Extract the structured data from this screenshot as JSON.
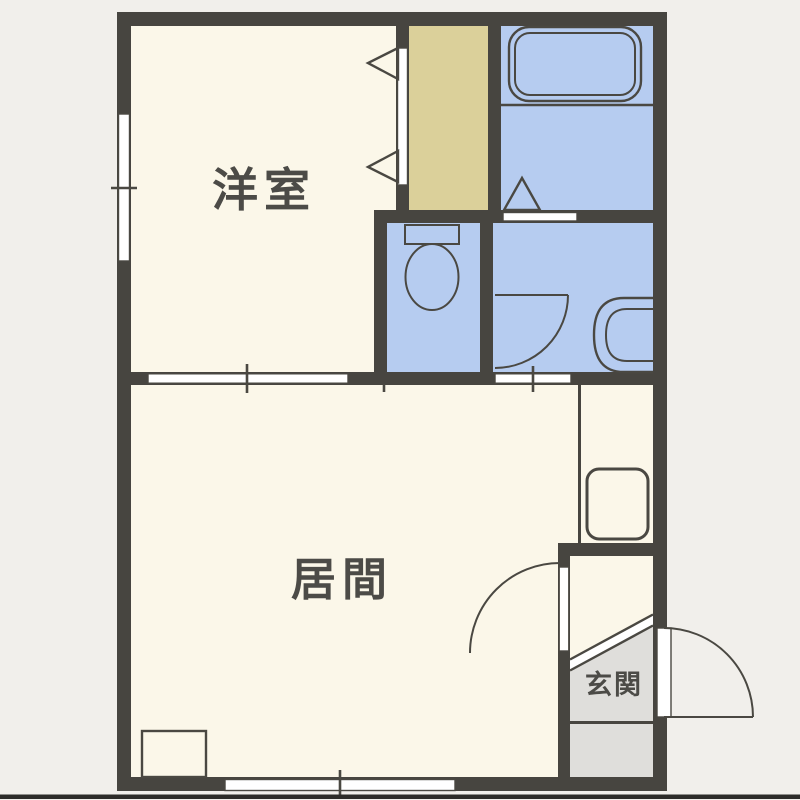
{
  "plan": {
    "type": "apartment-floor-plan",
    "labels": {
      "western_room": "洋室",
      "living_room": "居間",
      "entrance": "玄関"
    },
    "colors": {
      "bg": "#f1efeb",
      "wall": "#474540",
      "floor": "#fbf7e9",
      "wet_area": "#b6ccf0",
      "closet_fill": "#dbd09a",
      "entrance_floor": "#dfdedb",
      "opening": "#ffffff",
      "outline": "#4a4842",
      "label_text": "#4c4b47",
      "photo_edge": "#2d2c29"
    },
    "fixtures": [
      "bathtub",
      "bath-folding-door",
      "toilet",
      "washbasin",
      "washroom-door",
      "closet-bifold-door",
      "sliding-partition",
      "washing-machine-pan",
      "storage-box",
      "living-room-door",
      "entrance-door",
      "entrance-step",
      "window-left",
      "window-bottom"
    ]
  }
}
